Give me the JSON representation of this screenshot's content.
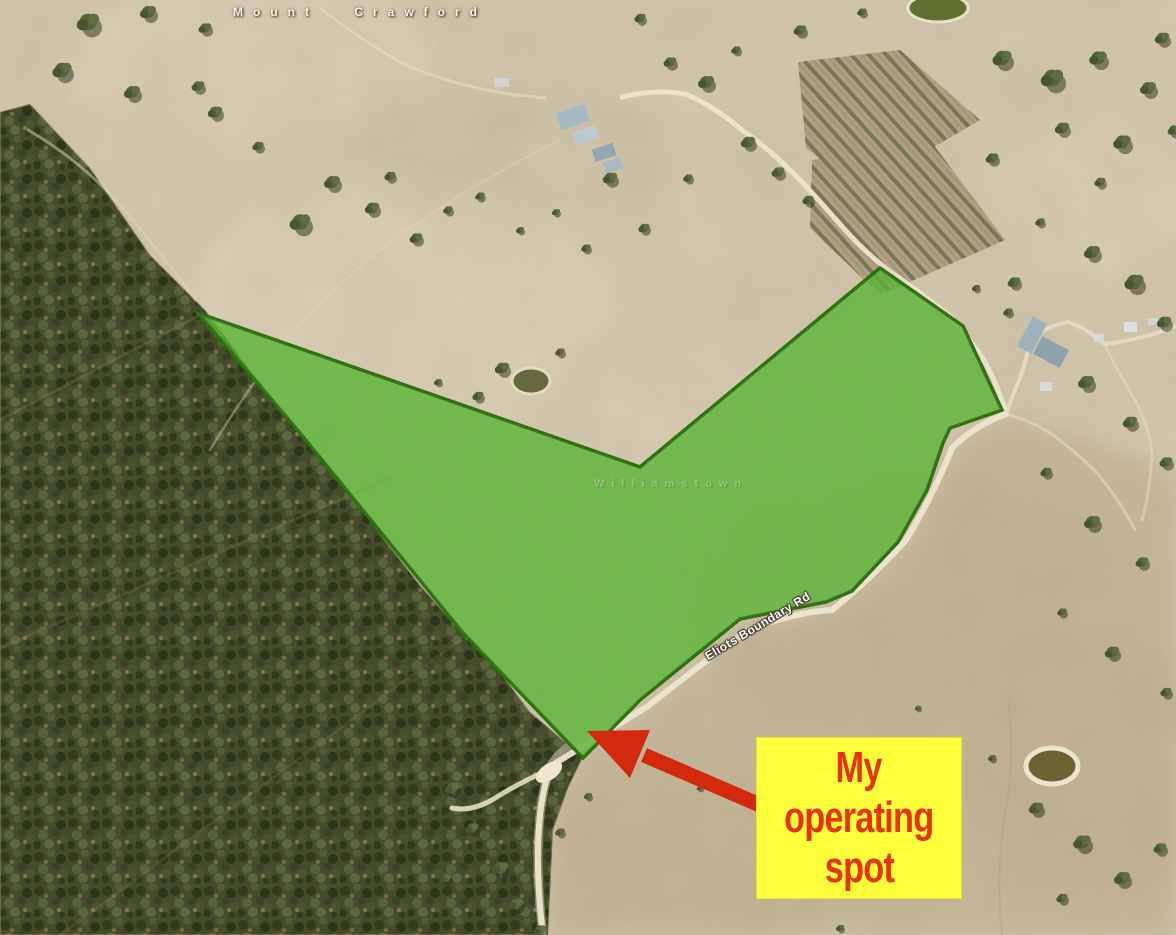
{
  "map": {
    "place_label": "Mount Crawford",
    "faint_place_label": "Williamstown",
    "road_label": "Eliots Boundary Rd",
    "terrain_base_color": "#cbbfa4"
  },
  "overlay": {
    "fill": "#53b52f",
    "stroke": "#2e6f10"
  },
  "arrow": {
    "color": "#d3290e"
  },
  "callout": {
    "lines": [
      "My",
      "operating",
      "spot"
    ],
    "text_color": "#ea3212",
    "background_color": "#fcff3a"
  }
}
